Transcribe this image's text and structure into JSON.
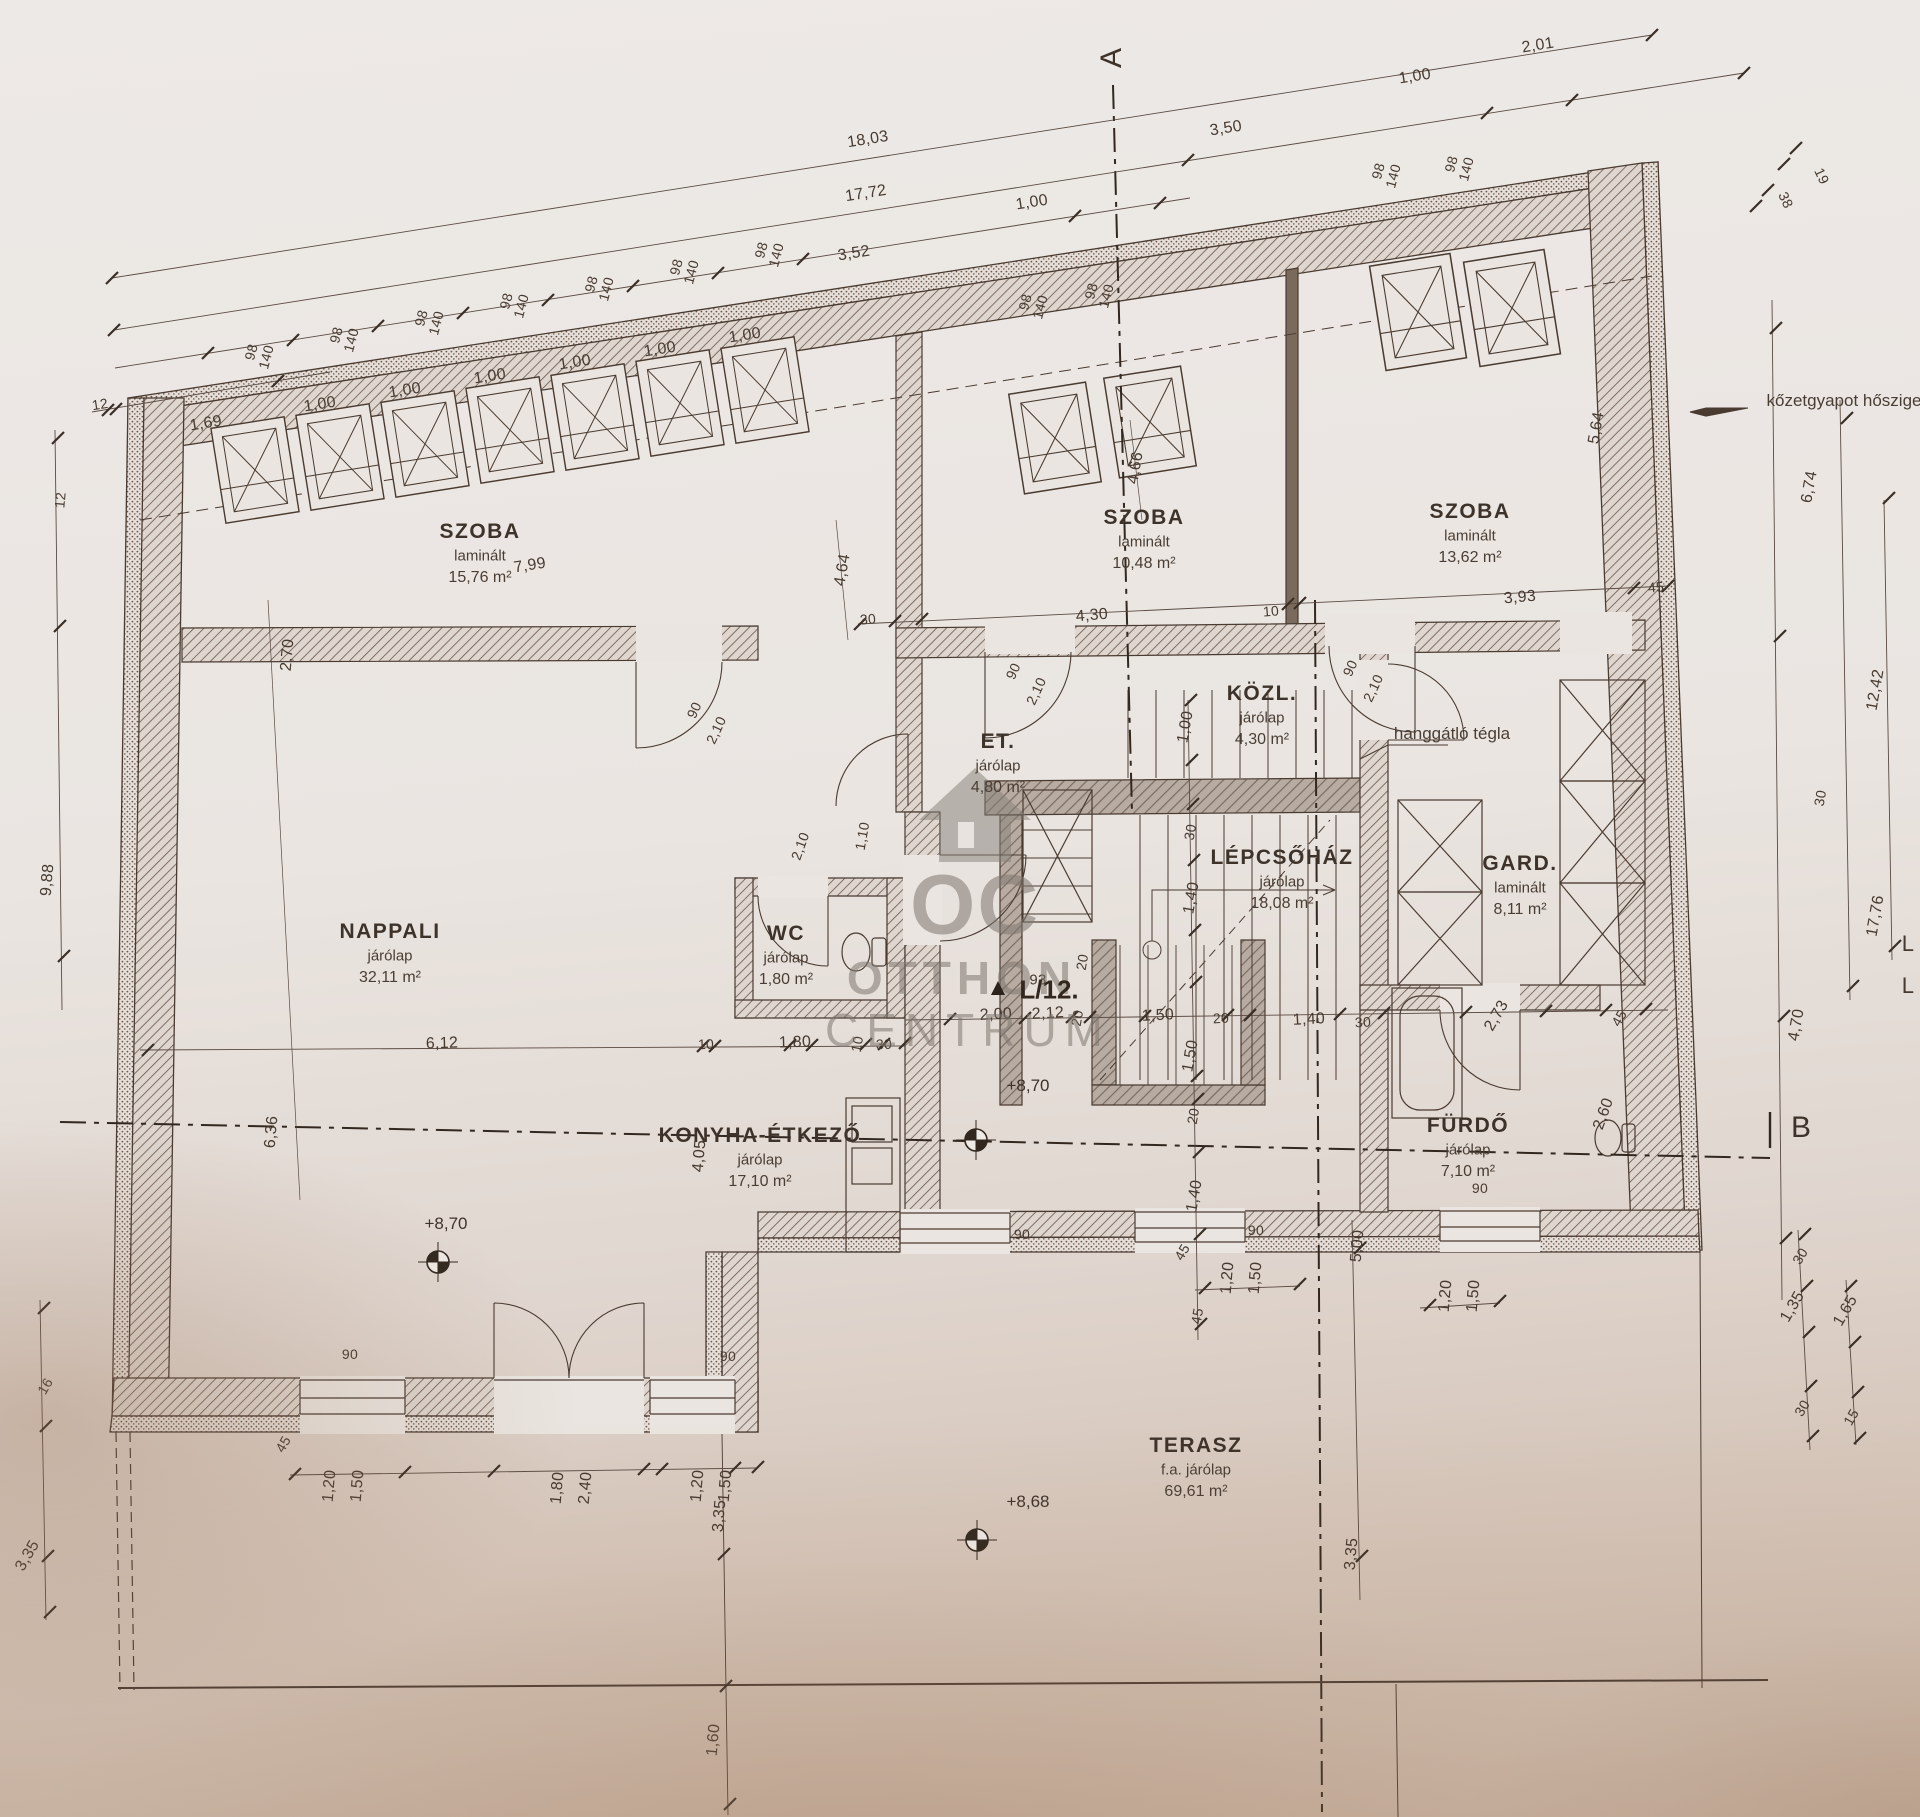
{
  "drawing": {
    "apartment_label": "L/12.",
    "section_markers": {
      "a": "A",
      "b": "B"
    },
    "watermark": {
      "logo": "OC",
      "line1": "OTTHON",
      "line2": "CENTRUM"
    },
    "notes": [
      {
        "t": "kőzetgyapot hőszige",
        "x": 1754,
        "y": 401,
        "anchor": "left"
      },
      {
        "t": "hanggátló tégla",
        "x": 1452,
        "y": 734,
        "anchor": "center"
      }
    ],
    "elevations": [
      {
        "t": "+8,70",
        "x": 446,
        "y": 1224
      },
      {
        "t": "+8,70",
        "x": 1028,
        "y": 1086
      },
      {
        "t": "+8,68",
        "x": 1028,
        "y": 1502
      }
    ],
    "rooms": [
      {
        "name": "SZOBA",
        "finish": "laminált",
        "area": "15,76 m²",
        "x": 480,
        "y": 532
      },
      {
        "name": "SZOBA",
        "finish": "laminált",
        "area": "10,48 m²",
        "x": 1144,
        "y": 518
      },
      {
        "name": "SZOBA",
        "finish": "laminált",
        "area": "13,62 m²",
        "x": 1470,
        "y": 512
      },
      {
        "name": "KÖZL.",
        "finish": "járólap",
        "area": "4,30 m²",
        "x": 1262,
        "y": 694
      },
      {
        "name": "ET.",
        "finish": "járólap",
        "area": "4,80 m²",
        "x": 998,
        "y": 742
      },
      {
        "name": "LÉPCSŐHÁZ",
        "finish": "járólap",
        "area": "18,08 m²",
        "x": 1282,
        "y": 858
      },
      {
        "name": "GARD.",
        "finish": "laminált",
        "area": "8,11 m²",
        "x": 1520,
        "y": 864
      },
      {
        "name": "NAPPALI",
        "finish": "járólap",
        "area": "32,11 m²",
        "x": 390,
        "y": 932
      },
      {
        "name": "WC",
        "finish": "járólap",
        "area": "1,80 m²",
        "x": 786,
        "y": 934
      },
      {
        "name": "KONYHA-ÉTKEZŐ",
        "finish": "járólap",
        "area": "17,10 m²",
        "x": 760,
        "y": 1136
      },
      {
        "name": "FÜRDŐ",
        "finish": "járólap",
        "area": "7,10 m²",
        "x": 1468,
        "y": 1126
      },
      {
        "name": "TERASZ",
        "finish": "f.a. járólap",
        "area": "69,61 m²",
        "x": 1196,
        "y": 1446
      }
    ],
    "dims": [
      {
        "t": "18,03",
        "x": 868,
        "y": 140,
        "r": -9
      },
      {
        "t": "17,72",
        "x": 866,
        "y": 194,
        "r": -9
      },
      {
        "t": "3,52",
        "x": 854,
        "y": 254,
        "r": -9
      },
      {
        "t": "12",
        "x": 100,
        "y": 404,
        "r": -9,
        "s": 14
      },
      {
        "t": "1,69",
        "x": 206,
        "y": 424,
        "r": -9
      },
      {
        "t": "1,00",
        "x": 320,
        "y": 405,
        "r": -9
      },
      {
        "t": "1,00",
        "x": 405,
        "y": 391,
        "r": -9
      },
      {
        "t": "1,00",
        "x": 490,
        "y": 377,
        "r": -9
      },
      {
        "t": "1,00",
        "x": 575,
        "y": 363,
        "r": -9
      },
      {
        "t": "1,00",
        "x": 660,
        "y": 350,
        "r": -9
      },
      {
        "t": "1,00",
        "x": 745,
        "y": 336,
        "r": -9
      },
      {
        "t": "1,00",
        "x": 1032,
        "y": 203,
        "r": -9
      },
      {
        "t": "3,50",
        "x": 1226,
        "y": 129,
        "r": -9
      },
      {
        "t": "1,00",
        "x": 1415,
        "y": 77,
        "r": -9
      },
      {
        "t": "2,01",
        "x": 1538,
        "y": 46,
        "r": -9
      },
      {
        "t": "38",
        "x": 1786,
        "y": 200,
        "r": 65,
        "s": 14
      },
      {
        "t": "19",
        "x": 1822,
        "y": 176,
        "r": 65,
        "s": 14
      },
      {
        "t": "98",
        "x": 251,
        "y": 352,
        "r": -75,
        "s": 14
      },
      {
        "t": "140",
        "x": 266,
        "y": 357,
        "r": -75,
        "s": 14
      },
      {
        "t": "98",
        "x": 336,
        "y": 335,
        "r": -75,
        "s": 14
      },
      {
        "t": "140",
        "x": 351,
        "y": 340,
        "r": -75,
        "s": 14
      },
      {
        "t": "98",
        "x": 421,
        "y": 318,
        "r": -75,
        "s": 14
      },
      {
        "t": "140",
        "x": 436,
        "y": 323,
        "r": -75,
        "s": 14
      },
      {
        "t": "98",
        "x": 506,
        "y": 301,
        "r": -75,
        "s": 14
      },
      {
        "t": "140",
        "x": 521,
        "y": 306,
        "r": -75,
        "s": 14
      },
      {
        "t": "98",
        "x": 591,
        "y": 284,
        "r": -75,
        "s": 14
      },
      {
        "t": "140",
        "x": 606,
        "y": 289,
        "r": -75,
        "s": 14
      },
      {
        "t": "98",
        "x": 676,
        "y": 267,
        "r": -75,
        "s": 14
      },
      {
        "t": "140",
        "x": 691,
        "y": 272,
        "r": -75,
        "s": 14
      },
      {
        "t": "98",
        "x": 761,
        "y": 250,
        "r": -75,
        "s": 14
      },
      {
        "t": "140",
        "x": 776,
        "y": 255,
        "r": -75,
        "s": 14
      },
      {
        "t": "98",
        "x": 1025,
        "y": 302,
        "r": -75,
        "s": 14
      },
      {
        "t": "140",
        "x": 1040,
        "y": 307,
        "r": -75,
        "s": 14
      },
      {
        "t": "98",
        "x": 1091,
        "y": 291,
        "r": -75,
        "s": 14
      },
      {
        "t": "140",
        "x": 1106,
        "y": 296,
        "r": -75,
        "s": 14
      },
      {
        "t": "98",
        "x": 1378,
        "y": 171,
        "r": -75,
        "s": 14
      },
      {
        "t": "140",
        "x": 1393,
        "y": 176,
        "r": -75,
        "s": 14
      },
      {
        "t": "98",
        "x": 1451,
        "y": 164,
        "r": -75,
        "s": 14
      },
      {
        "t": "140",
        "x": 1466,
        "y": 169,
        "r": -75,
        "s": 14
      },
      {
        "t": "12",
        "x": 60,
        "y": 500,
        "r": -85,
        "s": 14
      },
      {
        "t": "2,70",
        "x": 288,
        "y": 655,
        "r": -85
      },
      {
        "t": "9,88",
        "x": 48,
        "y": 880,
        "r": -85
      },
      {
        "t": "6,36",
        "x": 272,
        "y": 1132,
        "r": -85
      },
      {
        "t": "16",
        "x": 45,
        "y": 1386,
        "r": -60,
        "s": 14
      },
      {
        "t": "3,35",
        "x": 28,
        "y": 1556,
        "r": -60
      },
      {
        "t": "5,64",
        "x": 1597,
        "y": 428,
        "r": -80
      },
      {
        "t": "6,74",
        "x": 1810,
        "y": 487,
        "r": -80
      },
      {
        "t": "12,42",
        "x": 1876,
        "y": 690,
        "r": -80
      },
      {
        "t": "30",
        "x": 1820,
        "y": 798,
        "r": -80,
        "s": 14
      },
      {
        "t": "17,76",
        "x": 1876,
        "y": 916,
        "r": -80
      },
      {
        "t": "4,70",
        "x": 1797,
        "y": 1025,
        "r": -80
      },
      {
        "t": "L",
        "x": 1908,
        "y": 944,
        "r": 0,
        "s": 22
      },
      {
        "t": "L",
        "x": 1908,
        "y": 986,
        "r": 0,
        "s": 22
      },
      {
        "t": "30",
        "x": 1800,
        "y": 1256,
        "r": -60,
        "s": 14
      },
      {
        "t": "1,35",
        "x": 1793,
        "y": 1307,
        "r": -60
      },
      {
        "t": "1,65",
        "x": 1846,
        "y": 1311,
        "r": -60
      },
      {
        "t": "30",
        "x": 1802,
        "y": 1408,
        "r": -60,
        "s": 14
      },
      {
        "t": "15",
        "x": 1851,
        "y": 1417,
        "r": -60,
        "s": 14
      },
      {
        "t": "7,99",
        "x": 530,
        "y": 566,
        "r": -9
      },
      {
        "t": "4,64",
        "x": 843,
        "y": 570,
        "r": -80
      },
      {
        "t": "30",
        "x": 868,
        "y": 619,
        "r": -5,
        "s": 14
      },
      {
        "t": "4,30",
        "x": 1092,
        "y": 616,
        "r": -5
      },
      {
        "t": "10",
        "x": 1271,
        "y": 611,
        "r": -5,
        "s": 14
      },
      {
        "t": "3,93",
        "x": 1520,
        "y": 598,
        "r": -5
      },
      {
        "t": "45",
        "x": 1656,
        "y": 587,
        "r": -5,
        "s": 14
      },
      {
        "t": "4,66",
        "x": 1136,
        "y": 468,
        "r": -80
      },
      {
        "t": "90",
        "x": 1013,
        "y": 671,
        "r": -65,
        "s": 14
      },
      {
        "t": "2,10",
        "x": 1036,
        "y": 691,
        "r": -65,
        "s": 14
      },
      {
        "t": "90",
        "x": 1350,
        "y": 668,
        "r": -65,
        "s": 14
      },
      {
        "t": "2,10",
        "x": 1373,
        "y": 688,
        "r": -65,
        "s": 14
      },
      {
        "t": "90",
        "x": 694,
        "y": 710,
        "r": -65,
        "s": 14
      },
      {
        "t": "2,10",
        "x": 716,
        "y": 730,
        "r": -65,
        "s": 14
      },
      {
        "t": "1,00",
        "x": 1186,
        "y": 727,
        "r": -80
      },
      {
        "t": "30",
        "x": 1190,
        "y": 832,
        "r": -80,
        "s": 14
      },
      {
        "t": "1,40",
        "x": 1192,
        "y": 898,
        "r": -80
      },
      {
        "t": "20",
        "x": 1082,
        "y": 962,
        "r": -80,
        "s": 14
      },
      {
        "t": "1,50",
        "x": 1191,
        "y": 1056,
        "r": -80
      },
      {
        "t": "20",
        "x": 1193,
        "y": 1116,
        "r": -80,
        "s": 14
      },
      {
        "t": "1,40",
        "x": 1195,
        "y": 1196,
        "r": -80
      },
      {
        "t": "45",
        "x": 1197,
        "y": 1316,
        "r": -80,
        "s": 14
      },
      {
        "t": "93",
        "x": 1038,
        "y": 980,
        "r": 0,
        "s": 15
      },
      {
        "t": "2,00",
        "x": 996,
        "y": 1015,
        "r": -3
      },
      {
        "t": "2,12",
        "x": 1048,
        "y": 1014,
        "r": -3
      },
      {
        "t": "20",
        "x": 1077,
        "y": 1018,
        "r": -80,
        "s": 14
      },
      {
        "t": "1,50",
        "x": 1158,
        "y": 1016,
        "r": -3
      },
      {
        "t": "20",
        "x": 1221,
        "y": 1018,
        "r": -3,
        "s": 14
      },
      {
        "t": "1,40",
        "x": 1309,
        "y": 1020,
        "r": -3
      },
      {
        "t": "30",
        "x": 1363,
        "y": 1022,
        "r": -3,
        "s": 14
      },
      {
        "t": "2,73",
        "x": 1497,
        "y": 1016,
        "r": -60
      },
      {
        "t": "45",
        "x": 1619,
        "y": 1018,
        "r": -60,
        "s": 14
      },
      {
        "t": "2,60",
        "x": 1604,
        "y": 1114,
        "r": -70
      },
      {
        "t": "1,10",
        "x": 862,
        "y": 836,
        "r": -80,
        "s": 14
      },
      {
        "t": "2,10",
        "x": 800,
        "y": 846,
        "r": -70,
        "s": 14
      },
      {
        "t": "6,12",
        "x": 442,
        "y": 1044,
        "r": -2
      },
      {
        "t": "10",
        "x": 706,
        "y": 1044,
        "r": -2,
        "s": 14
      },
      {
        "t": "1,80",
        "x": 795,
        "y": 1043,
        "r": -2
      },
      {
        "t": "10",
        "x": 857,
        "y": 1044,
        "r": -80,
        "s": 14
      },
      {
        "t": "30",
        "x": 884,
        "y": 1044,
        "r": -2,
        "s": 14
      },
      {
        "t": "4,05",
        "x": 700,
        "y": 1156,
        "r": -85
      },
      {
        "t": "90",
        "x": 350,
        "y": 1354,
        "r": 0,
        "s": 14
      },
      {
        "t": "90",
        "x": 728,
        "y": 1356,
        "r": 0,
        "s": 14
      },
      {
        "t": "45",
        "x": 283,
        "y": 1444,
        "r": -60,
        "s": 14
      },
      {
        "t": "45",
        "x": 1182,
        "y": 1252,
        "r": -60,
        "s": 14
      },
      {
        "t": "90",
        "x": 1022,
        "y": 1234,
        "r": 0,
        "s": 14
      },
      {
        "t": "90",
        "x": 1256,
        "y": 1230,
        "r": 0,
        "s": 14
      },
      {
        "t": "90",
        "x": 1480,
        "y": 1188,
        "r": 0,
        "s": 14
      },
      {
        "t": "1,20",
        "x": 330,
        "y": 1486,
        "r": -85
      },
      {
        "t": "1,50",
        "x": 358,
        "y": 1486,
        "r": -85
      },
      {
        "t": "1,80",
        "x": 558,
        "y": 1488,
        "r": -85
      },
      {
        "t": "2,40",
        "x": 586,
        "y": 1488,
        "r": -85
      },
      {
        "t": "1,20",
        "x": 698,
        "y": 1486,
        "r": -85
      },
      {
        "t": "1,50",
        "x": 726,
        "y": 1486,
        "r": -85
      },
      {
        "t": "1,20",
        "x": 1228,
        "y": 1278,
        "r": -85
      },
      {
        "t": "1,50",
        "x": 1256,
        "y": 1278,
        "r": -85
      },
      {
        "t": "1,20",
        "x": 1446,
        "y": 1296,
        "r": -85
      },
      {
        "t": "1,50",
        "x": 1474,
        "y": 1296,
        "r": -85
      },
      {
        "t": "3,35",
        "x": 720,
        "y": 1516,
        "r": -85
      },
      {
        "t": "1,60",
        "x": 714,
        "y": 1740,
        "r": -85
      },
      {
        "t": "5,00",
        "x": 1358,
        "y": 1246,
        "r": -85
      },
      {
        "t": "3,35",
        "x": 1352,
        "y": 1554,
        "r": -85
      }
    ]
  }
}
